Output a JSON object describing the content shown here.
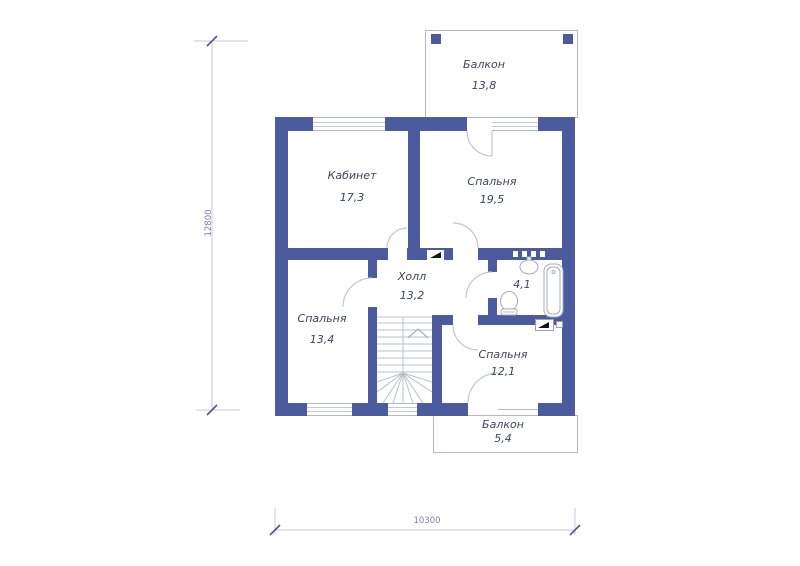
{
  "drawing": {
    "type": "floor-plan",
    "language": "ru",
    "colors": {
      "wall": "#4b5b9d",
      "outline": "#b6b9c4",
      "room_text": "#3e4459",
      "dimension_text": "#7b7dae",
      "background": "#ffffff"
    }
  },
  "rooms": {
    "balcony_top": {
      "name": "Балкон",
      "area": "13,8"
    },
    "study": {
      "name": "Кабинет",
      "area": "17,3"
    },
    "bedroom1": {
      "name": "Спальня",
      "area": "19,5"
    },
    "hall": {
      "name": "Холл",
      "area": "13,2"
    },
    "bathroom": {
      "area": "4,1"
    },
    "bedroom2": {
      "name": "Спальня",
      "area": "13,4"
    },
    "bedroom3": {
      "name": "Спальня",
      "area": "12,1"
    },
    "balcony_bottom": {
      "name": "Балкон",
      "area": "5,4"
    }
  },
  "dimensions": {
    "vertical": "12800",
    "horizontal": "10300"
  },
  "symbols": [
    "ventilation-flag-icon",
    "bathtub-icon",
    "toilet-icon",
    "sink-icon",
    "stairs-up-icon"
  ]
}
